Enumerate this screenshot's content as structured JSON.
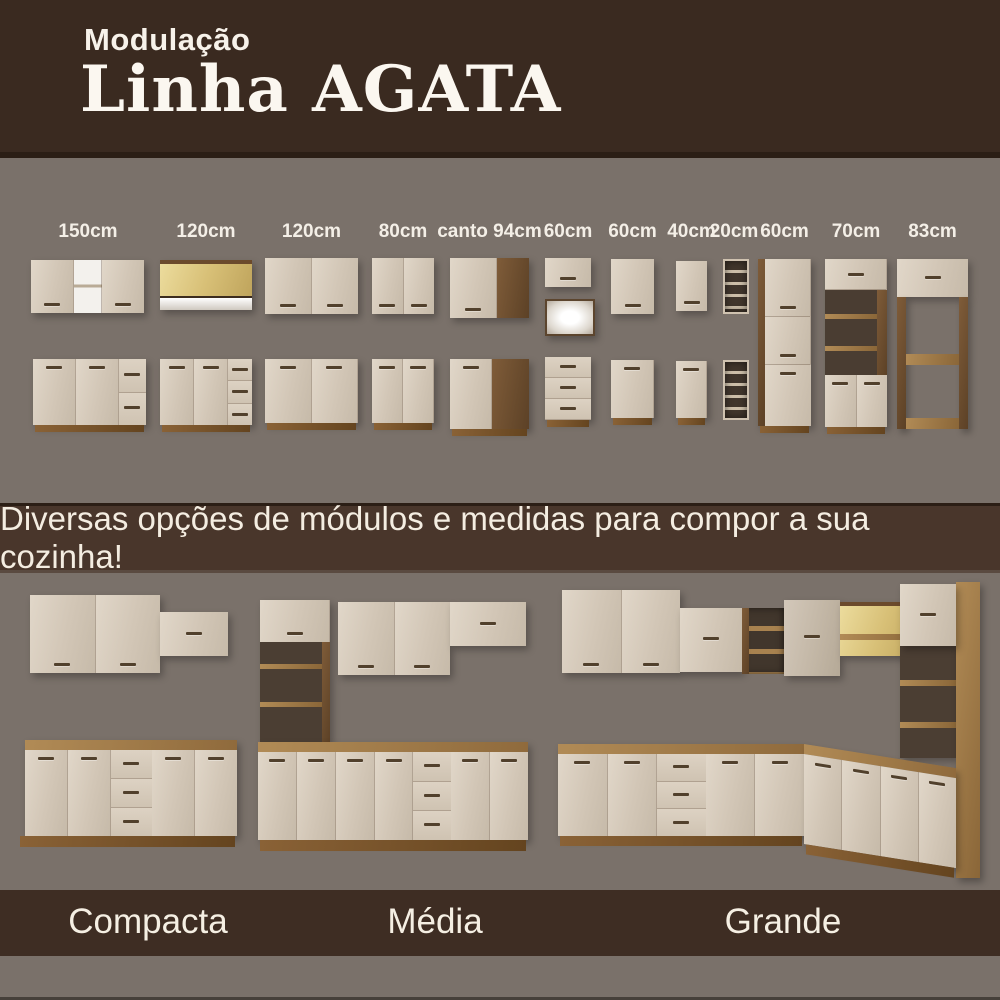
{
  "header": {
    "kicker": "Modulação",
    "title": "Linha AGATA"
  },
  "modules": {
    "labels": [
      "150cm",
      "120cm",
      "120cm",
      "80cm",
      "canto 94cm",
      "60cm",
      "60cm",
      "40cm",
      "20cm",
      "60cm",
      "70cm",
      "83cm"
    ]
  },
  "banner": {
    "text": "Diversas opções de módulos e medidas para compor a sua cozinha!"
  },
  "kitchens": {
    "labels": [
      "Compacta",
      "Média",
      "Grande"
    ]
  },
  "colors": {
    "background": "#7a716a",
    "header_bg": "#3a2a20",
    "banner_bg": "#49362b",
    "footer_bg": "#3e2d23",
    "cabinet_cream": "#d8ccbd",
    "wood_dark": "#5c4126",
    "wood_oak": "#a8824f",
    "glass_light": "#ddc887",
    "text_light": "#f5efe3"
  }
}
